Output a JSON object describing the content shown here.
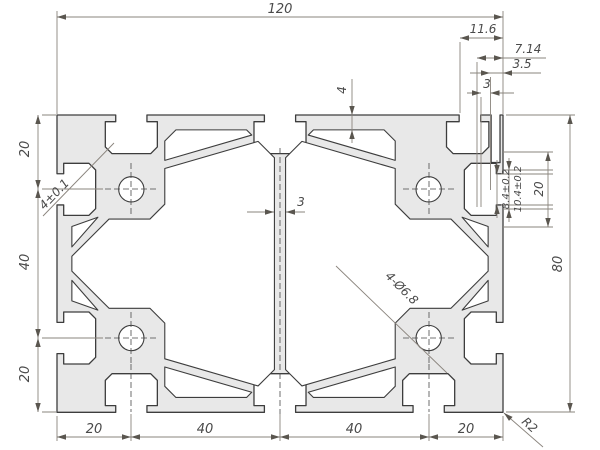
{
  "drawing": {
    "title": "aluminum-extrusion-profile-cross-section",
    "colors": {
      "profile_fill": "#e8e8e8",
      "outline": "#3d3d3d",
      "dimension_lines": "#8a847d",
      "text": "#4a4a4a"
    },
    "dims": {
      "overall_width": "120",
      "overall_height": "80",
      "top_offset": "11.6",
      "slot_depth": "7.14",
      "lip_offset": "3.5",
      "wall_small": "3",
      "top_wall": "4",
      "web": "3",
      "left_chain": [
        "20",
        "40",
        "20"
      ],
      "bottom_chain": [
        "20",
        "40",
        "40",
        "20"
      ],
      "slot_opening": "8.4±0.2",
      "slot_cavity": "10.4±0.2",
      "slot_span": "20",
      "lip_thickness": "4±0.1",
      "hole_spec": "4-Ø6.8",
      "corner_radius": "R2"
    }
  }
}
